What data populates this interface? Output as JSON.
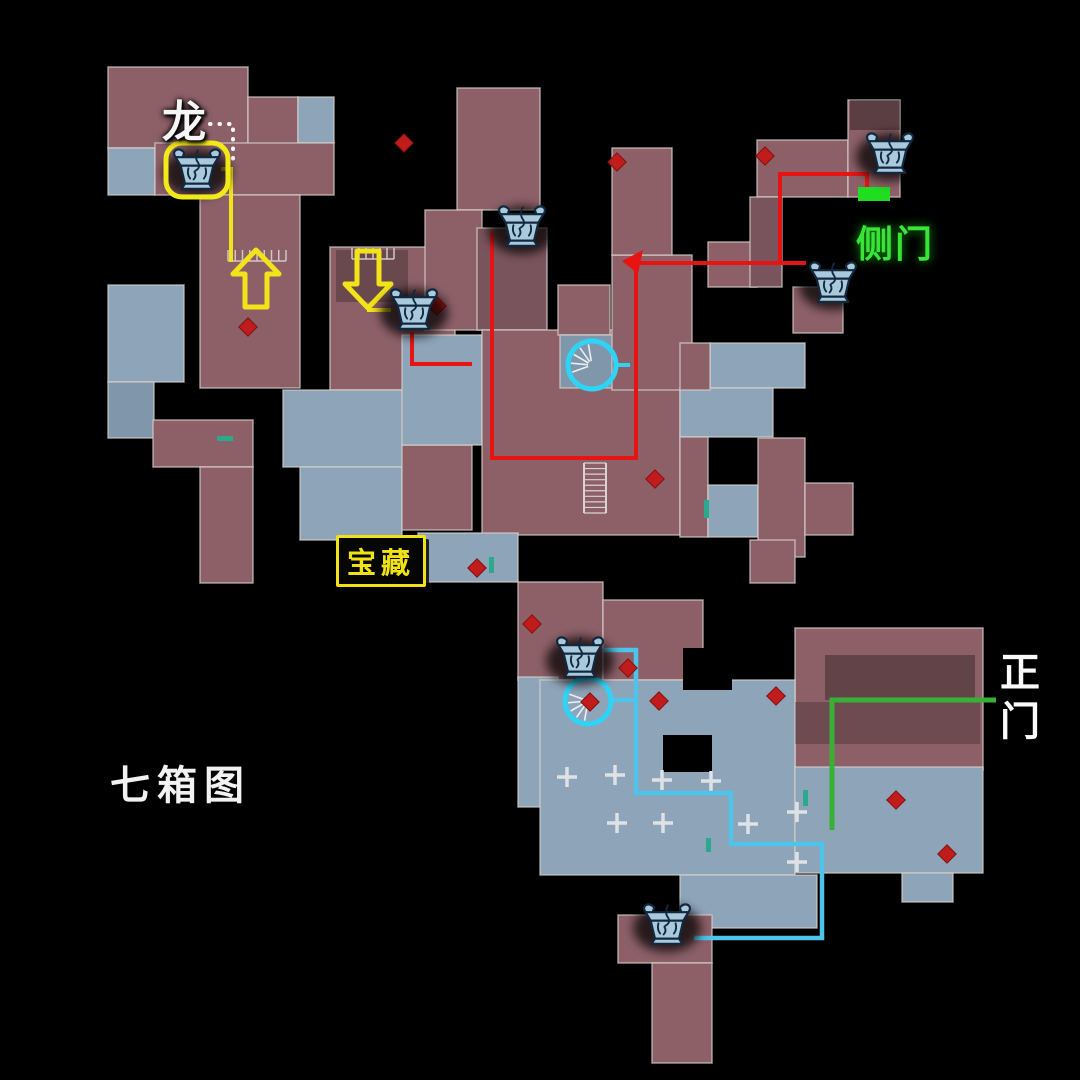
{
  "labels": {
    "dragon": "龙",
    "side_door": "侧门",
    "treasure": "宝藏",
    "map_name": "七箱图",
    "main_gate": "正门",
    "main_gate_char1": "正",
    "main_gate_char2": "门"
  },
  "chest_count": 7,
  "colors": {
    "background": "#000000",
    "room_mauve": "#8d6068",
    "room_mauve_dark": "#7a545c",
    "room_blue": "#8ea4b9",
    "room_blue_dark": "#8096ab",
    "wall": "#d6d0cb",
    "route_red": "#e81414",
    "route_yellow": "#f2e418",
    "route_cyan": "#4ec4ea",
    "route_green": "#3aaf36",
    "door_green": "#1fdd1f",
    "marker_red": "#c01c1c",
    "circle_cyan": "#2ed3f5",
    "chest_fill": "#a9c9dd",
    "chest_stroke": "#12283e",
    "glow_yellow": "#f2ea18",
    "text_white": "#f5f5f5",
    "text_green": "#39e439",
    "text_yellow": "#f0e217"
  },
  "map": {
    "rooms": [
      [
        108,
        67,
        140,
        81,
        "m"
      ],
      [
        248,
        97,
        50,
        51,
        "m"
      ],
      [
        298,
        97,
        36,
        46,
        "b"
      ],
      [
        108,
        148,
        47,
        47,
        "b"
      ],
      [
        155,
        143,
        179,
        52,
        "m"
      ],
      [
        200,
        195,
        100,
        193,
        "m"
      ],
      [
        108,
        285,
        76,
        97,
        "b"
      ],
      [
        108,
        382,
        46,
        56,
        "bd"
      ],
      [
        153,
        420,
        100,
        47,
        "m"
      ],
      [
        200,
        467,
        53,
        116,
        "m"
      ],
      [
        330,
        247,
        125,
        143,
        "m"
      ],
      [
        283,
        390,
        142,
        77,
        "b"
      ],
      [
        300,
        467,
        102,
        73,
        "b"
      ],
      [
        402,
        445,
        70,
        85,
        "m"
      ],
      [
        402,
        335,
        80,
        110,
        "b"
      ],
      [
        457,
        88,
        83,
        122,
        "m"
      ],
      [
        425,
        210,
        57,
        120,
        "m"
      ],
      [
        477,
        228,
        70,
        102,
        "d"
      ],
      [
        482,
        330,
        198,
        205,
        "m"
      ],
      [
        558,
        285,
        52,
        50,
        "m"
      ],
      [
        560,
        335,
        57,
        53,
        "bd"
      ],
      [
        612,
        255,
        80,
        135,
        "m"
      ],
      [
        612,
        148,
        60,
        107,
        "m"
      ],
      [
        757,
        140,
        91,
        57,
        "m"
      ],
      [
        848,
        100,
        52,
        97,
        "m"
      ],
      [
        708,
        242,
        49,
        45,
        "m"
      ],
      [
        750,
        197,
        32,
        90,
        "d"
      ],
      [
        793,
        287,
        50,
        46,
        "m"
      ],
      [
        710,
        343,
        95,
        45,
        "b"
      ],
      [
        680,
        388,
        93,
        49,
        "b"
      ],
      [
        680,
        343,
        30,
        47,
        "m"
      ],
      [
        680,
        437,
        28,
        100,
        "m"
      ],
      [
        708,
        485,
        50,
        52,
        "b"
      ],
      [
        758,
        438,
        47,
        119,
        "m"
      ],
      [
        805,
        483,
        48,
        52,
        "m"
      ],
      [
        418,
        533,
        100,
        49,
        "b"
      ],
      [
        518,
        582,
        85,
        98,
        "m"
      ],
      [
        518,
        677,
        40,
        130,
        "b"
      ],
      [
        603,
        600,
        100,
        80,
        "m"
      ],
      [
        750,
        540,
        45,
        43,
        "m"
      ],
      [
        795,
        628,
        188,
        142,
        "m"
      ],
      [
        540,
        680,
        255,
        195,
        "b"
      ],
      [
        795,
        767,
        188,
        106,
        "b"
      ],
      [
        902,
        873,
        51,
        29,
        "b"
      ],
      [
        680,
        875,
        137,
        53,
        "b"
      ],
      [
        618,
        915,
        94,
        48,
        "m"
      ],
      [
        652,
        963,
        60,
        100,
        "m"
      ]
    ],
    "shades": [
      [
        336,
        250,
        72,
        52,
        0.25
      ],
      [
        825,
        655,
        150,
        45,
        0.3
      ],
      [
        795,
        702,
        185,
        42,
        0.22
      ],
      [
        850,
        100,
        50,
        30,
        0.35
      ],
      [
        683,
        648,
        49,
        42,
        1
      ],
      [
        663,
        735,
        49,
        37,
        1
      ]
    ],
    "routes": [
      {
        "name": "route-red-chest3",
        "color": "route_red",
        "width": 4,
        "points": [
          [
            412,
            332
          ],
          [
            412,
            364
          ],
          [
            472,
            364
          ]
        ]
      },
      {
        "name": "route-red-main",
        "color": "route_red",
        "width": 4,
        "points": [
          [
            492,
            232
          ],
          [
            492,
            458
          ],
          [
            636,
            458
          ],
          [
            636,
            263
          ],
          [
            806,
            263
          ]
        ]
      },
      {
        "name": "route-red-sidedoor",
        "color": "route_red",
        "width": 4,
        "points": [
          [
            780,
            263
          ],
          [
            780,
            174
          ],
          [
            867,
            174
          ],
          [
            867,
            188
          ]
        ]
      },
      {
        "name": "route-yellow-chest1",
        "color": "route_yellow",
        "width": 4,
        "points": [
          [
            221,
            169
          ],
          [
            231,
            169
          ],
          [
            231,
            262
          ]
        ]
      },
      {
        "name": "route-yellow-chest3-link",
        "color": "route_yellow",
        "width": 4,
        "points": [
          [
            367,
            310
          ],
          [
            391,
            310
          ]
        ]
      },
      {
        "name": "route-cyan-lower",
        "color": "route_cyan",
        "width": 4.5,
        "points": [
          [
            604,
            650
          ],
          [
            636,
            650
          ],
          [
            636,
            793
          ],
          [
            731,
            793
          ],
          [
            731,
            844
          ],
          [
            822,
            844
          ],
          [
            822,
            938
          ],
          [
            694,
            938
          ]
        ]
      },
      {
        "name": "route-cyan-circle-link",
        "color": "route_cyan",
        "width": 4.5,
        "points": [
          [
            612,
            700
          ],
          [
            636,
            700
          ]
        ]
      },
      {
        "name": "route-cyan-circle1-tick",
        "color": "circle_cyan",
        "width": 4,
        "points": [
          [
            616,
            365
          ],
          [
            630,
            365
          ]
        ]
      },
      {
        "name": "route-green-maingate",
        "color": "route_green",
        "width": 5,
        "points": [
          [
            996,
            700
          ],
          [
            832,
            700
          ],
          [
            832,
            830
          ]
        ]
      }
    ],
    "dotted_trail": [
      [
        210,
        124
      ],
      [
        233,
        124
      ],
      [
        233,
        166
      ]
    ],
    "red_arrowhead": [
      [
        622,
        261
      ],
      [
        643,
        250
      ],
      [
        638,
        274
      ]
    ],
    "diamonds": [
      [
        248,
        327
      ],
      [
        404,
        143
      ],
      [
        765,
        156
      ],
      [
        617,
        162
      ],
      [
        628,
        668
      ],
      [
        659,
        701
      ],
      [
        776,
        696
      ],
      [
        896,
        800
      ],
      [
        532,
        624
      ],
      [
        655,
        479
      ],
      [
        590,
        702
      ],
      [
        437,
        306
      ],
      [
        477,
        568
      ],
      [
        947,
        854
      ]
    ],
    "circles": [
      {
        "x": 592,
        "y": 365,
        "r": 24,
        "rays": [
          160,
          185,
          210,
          235,
          260
        ]
      },
      {
        "x": 588,
        "y": 701,
        "r": 23,
        "rays": [
          100,
          125,
          150,
          175,
          200
        ]
      }
    ],
    "arrows": [
      {
        "x": 256,
        "y": 250,
        "dir": "up"
      },
      {
        "x": 368,
        "y": 308,
        "dir": "down"
      }
    ],
    "chests": [
      {
        "x": 197,
        "y": 170,
        "glow": true
      },
      {
        "x": 522,
        "y": 227,
        "glow": false
      },
      {
        "x": 414,
        "y": 310,
        "glow": false
      },
      {
        "x": 890,
        "y": 154,
        "glow": false
      },
      {
        "x": 833,
        "y": 283,
        "glow": false
      },
      {
        "x": 580,
        "y": 658,
        "glow": false
      },
      {
        "x": 667,
        "y": 925,
        "glow": false
      }
    ],
    "side_door_marker": {
      "x": 858,
      "y": 187,
      "w": 32,
      "h": 14
    },
    "stairs": {
      "x": 584,
      "y": 463,
      "w": 22,
      "h": 50,
      "steps": 9
    },
    "railings": [
      {
        "x": 228,
        "y": 250,
        "w": 58,
        "teeth": 9
      },
      {
        "x": 352,
        "y": 248,
        "w": 42,
        "teeth": 7
      }
    ],
    "teal_ticks": [
      [
        217,
        436,
        16,
        5
      ],
      [
        704,
        500,
        5,
        18
      ],
      [
        489,
        557,
        5,
        16
      ],
      [
        706,
        838,
        5,
        14
      ],
      [
        803,
        790,
        5,
        16
      ]
    ],
    "wall_crosses": [
      [
        567,
        777
      ],
      [
        615,
        775
      ],
      [
        662,
        780
      ],
      [
        711,
        781
      ],
      [
        617,
        823
      ],
      [
        663,
        823
      ],
      [
        748,
        824
      ],
      [
        797,
        812
      ],
      [
        797,
        862
      ]
    ]
  }
}
